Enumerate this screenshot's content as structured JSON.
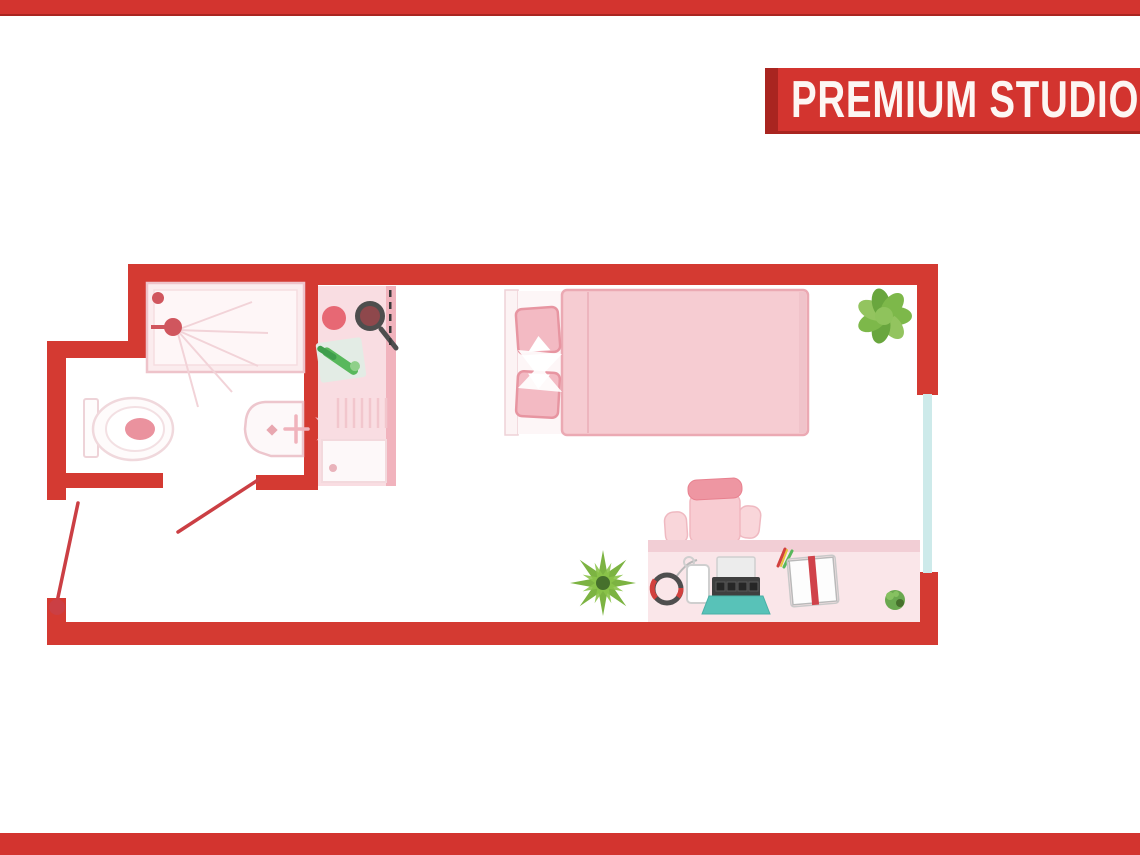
{
  "banner": {
    "title": "PREMIUM STUDIO"
  },
  "colors": {
    "brand_red": "#d3342f",
    "brand_red_dark": "#a92520",
    "wall_red": "#d43a32",
    "door_red": "#cb3f44",
    "window_teal": "#cdeaea",
    "pink_fill": "#f9dde2",
    "pink_strip": "#f1b3bd",
    "pink_outline": "#eec3ca",
    "fixture_white": "#fdf8f9",
    "duvet_pink": "#f6ccd2",
    "duvet_edge": "#eba9b3",
    "pillow_pink": "#f3bac3",
    "pillow_edge": "#e795a1",
    "chair_pink": "#f8ccd2",
    "chair_headrest": "#ee96a2",
    "desk_pink": "#fae6e9",
    "desk_band": "#f2ced5",
    "burner_red": "#e76874",
    "pan_gray": "#4e4e4e",
    "pan_inner": "#8e484c",
    "laptop_teal": "#58c2b8",
    "gadget_dark": "#3f3f3f",
    "accent_red": "#d2413e",
    "veg_green": "#58b85c",
    "plant_green": "#7cb342",
    "plant_green_light": "#8bc34a",
    "plant_green_dark": "#46702c",
    "leaf_a": "#7db84a",
    "leaf_b": "#93c45f",
    "leaf_c": "#69a63e",
    "book_red": "#d0424a"
  },
  "floorplan": {
    "label": "Premium studio floor plan",
    "objects": [
      "shower",
      "toilet",
      "washbasin",
      "basin-tap",
      "kitchen-counter",
      "hob-burner",
      "frying-pan",
      "cutting-board",
      "kitchen-sink",
      "bed",
      "pillows",
      "duvet",
      "office-chair",
      "desk",
      "headphones",
      "desk-lamp",
      "laptop",
      "pens",
      "open-book",
      "desk-plant",
      "potted-plant-large",
      "floor-plant",
      "window",
      "entrance-door",
      "bathroom-door"
    ]
  }
}
